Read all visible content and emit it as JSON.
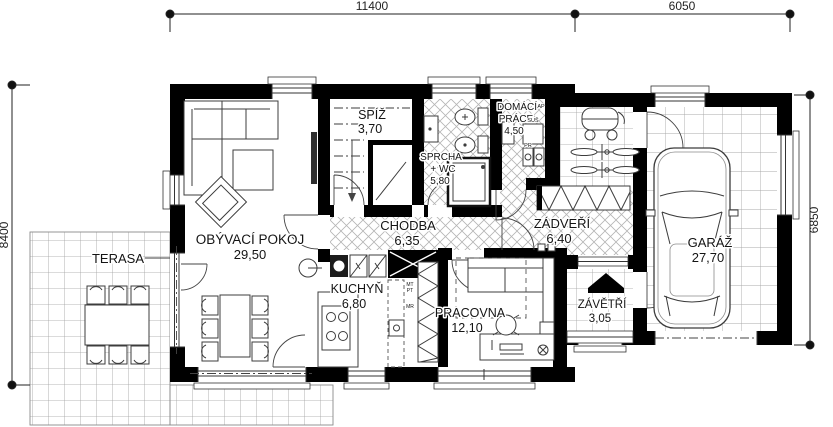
{
  "dimensions": {
    "width_main": "11400",
    "width_garage": "6050",
    "height_left": "8400",
    "height_right": "6850"
  },
  "rooms": {
    "terasa": {
      "label": "TERASA"
    },
    "obyvaci_pokoj": {
      "label": "OBÝVACÍ POKOJ",
      "area": "29,50"
    },
    "spiz": {
      "label": "SPÍŽ",
      "area": "3,70"
    },
    "sprcha": {
      "label": "SPRCHA",
      "label2": "+ WC",
      "area": "5,80"
    },
    "domaci_prace": {
      "label": "DOMÁCÍ",
      "label2": "PRÁCE",
      "area": "4,50"
    },
    "chodba": {
      "label": "CHODBA",
      "area": "6,35"
    },
    "zadveri": {
      "label": "ZÁDVEŘÍ",
      "area": "6,40"
    },
    "garaz": {
      "label": "GARÁŽ",
      "area": "27,70"
    },
    "kuchyn": {
      "label": "KUCHYŇ",
      "area": "6,80"
    },
    "pracovna": {
      "label": "PRACOVNA",
      "area": "12,10"
    },
    "zavetri": {
      "label": "ZÁVĚTŘÍ",
      "area": "3,05"
    }
  },
  "appliances": {
    "ap": "AP",
    "sus": "SUŠ",
    "pr": "PR",
    "mt": "MT",
    "pt": "PT",
    "mr": "MR"
  },
  "colors": {
    "wall": "#000000",
    "furniture_line": "#3c3c3c",
    "tile_line": "#b5b5b5",
    "background": "#ffffff"
  }
}
